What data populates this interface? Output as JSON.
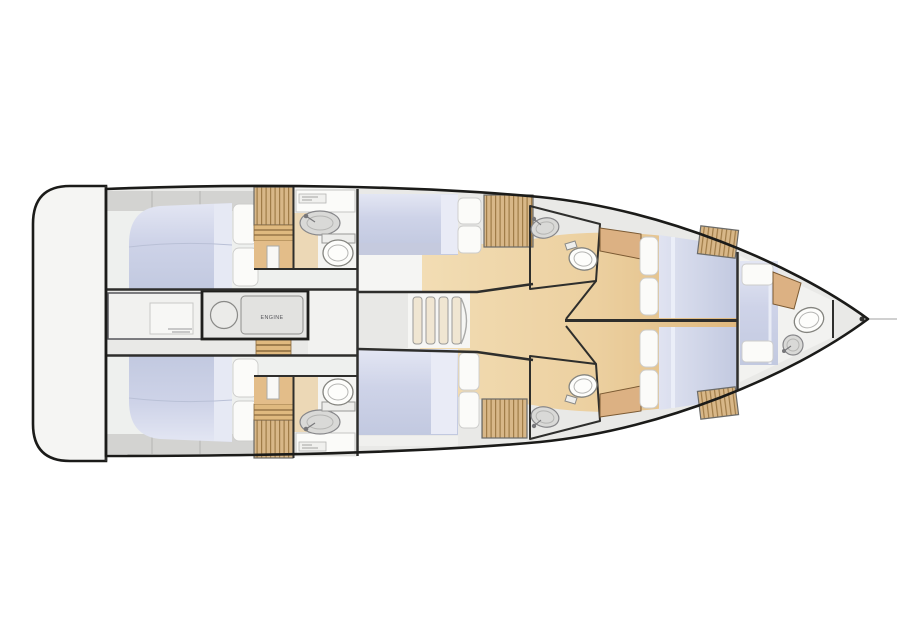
{
  "diagram": {
    "kind": "yacht-interior-deck-plan",
    "engine_room_label": "ENGINE"
  },
  "colors": {
    "outline": "#1b1b19",
    "wall": "#2e2e2c",
    "hull_fill": "#e9e9e7",
    "platform_fill": "#f5f5f3",
    "cabin_floor": "#eef0ee",
    "floor_white": "#f5f5f3",
    "gray_strip": "#d3d3d1",
    "pillow": "#fbfbf9",
    "fixture": "#fdfdfb",
    "fixture_stroke": "#84847f",
    "sink": "#d9d9d7",
    "counter": "#fbfbf9",
    "cabinet": "#dcb183",
    "bed_light": "#e3e6f3",
    "bed_mid": "#ced3e8",
    "bed_dark": "#c2c9e0",
    "wood_light": "#f2ddb4",
    "wood_dark": "#dfb87e",
    "slat_wood": "#d8b788",
    "slat_line": "#a07c48"
  }
}
